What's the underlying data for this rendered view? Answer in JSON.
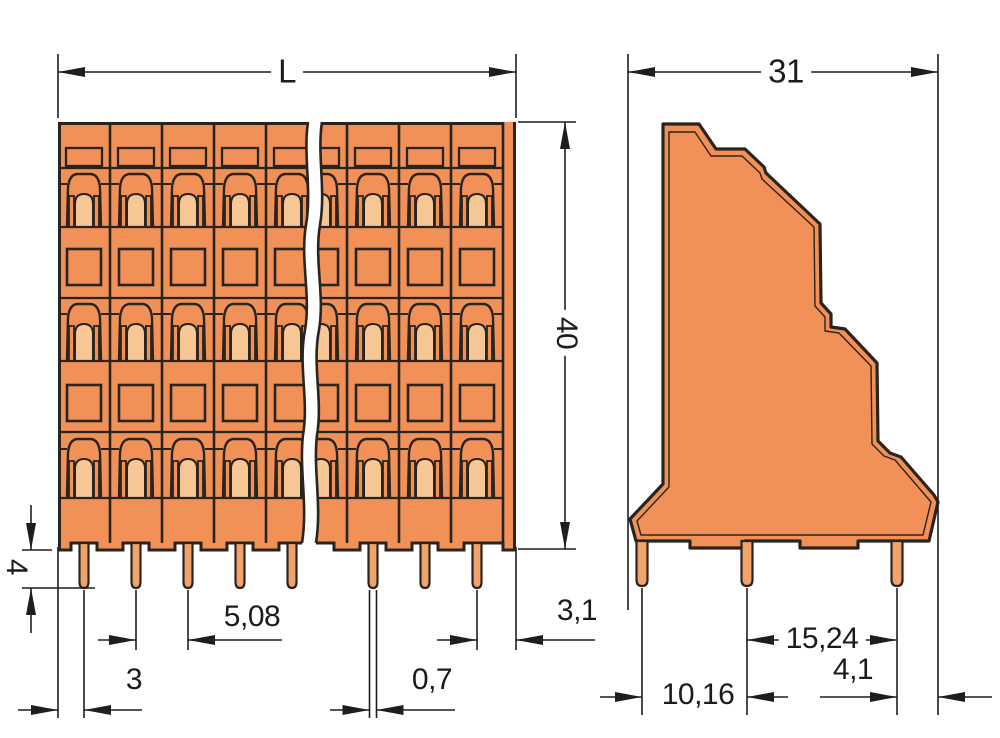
{
  "front_view": {
    "dims": {
      "overall_length": "L",
      "height": "40",
      "pin_length": "4",
      "pin_pitch": "5,08",
      "edge_to_first_pin": "3",
      "pin_width": "0,7",
      "last_pin_to_edge": "3,1"
    },
    "poles_visible": 8,
    "deck_rows": 3
  },
  "side_view": {
    "dims": {
      "overall_depth": "31",
      "pin_row_spacing_back": "15,24",
      "pin_to_back_edge": "4,1",
      "pin_row_spacing_front": "10,16"
    },
    "pins_visible": 3
  },
  "colors": {
    "housing_orange": "#F19158",
    "clamp_light": "#F6C795",
    "pin_copper": "#F2A26B",
    "outline_dark": "#2A241E",
    "dimension_line": "#1E1E1E"
  }
}
